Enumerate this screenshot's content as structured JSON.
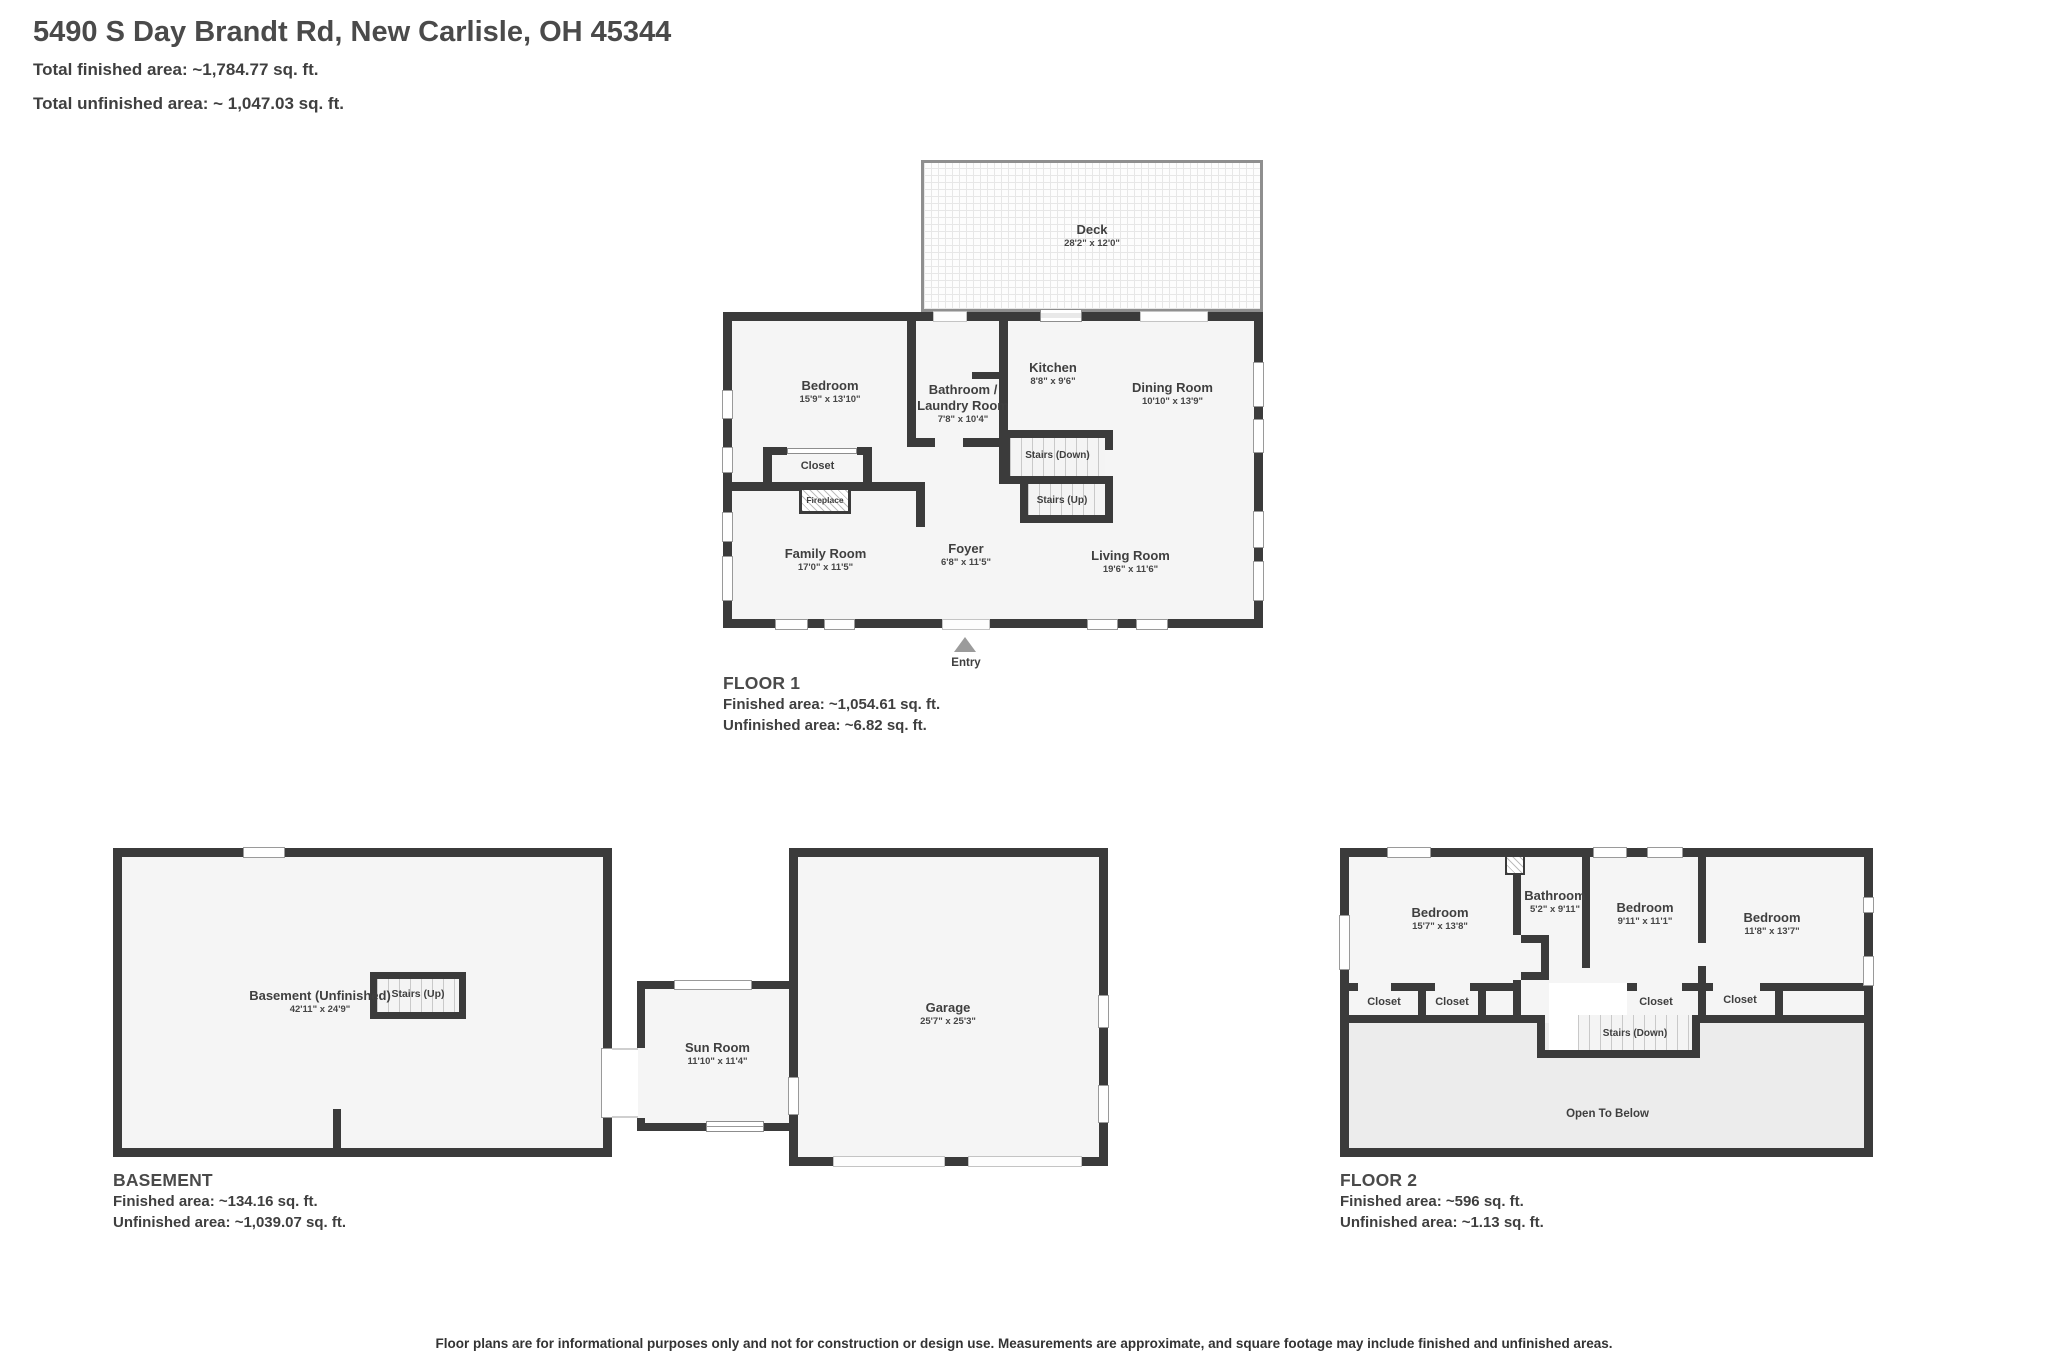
{
  "header": {
    "title": "5490 S Day Brandt Rd, New Carlisle, OH 45344",
    "total_finished": "Total finished area: ~1,784.77 sq. ft.",
    "total_unfinished": "Total unfinished area: ~ 1,047.03 sq. ft."
  },
  "floor1": {
    "title": "FLOOR 1",
    "finished": "Finished area: ~1,054.61 sq. ft.",
    "unfinished": "Unfinished area: ~6.82 sq. ft.",
    "deck": {
      "name": "Deck",
      "dims": "28'2\" x 12'0\""
    },
    "bedroom": {
      "name": "Bedroom",
      "dims": "15'9\" x 13'10\""
    },
    "bathroom": {
      "name": "Bathroom /",
      "name2": "Laundry Room",
      "dims": "7'8\" x 10'4\""
    },
    "kitchen": {
      "name": "Kitchen",
      "dims": "8'8\" x 9'6\""
    },
    "dining": {
      "name": "Dining Room",
      "dims": "10'10\" x 13'9\""
    },
    "family": {
      "name": "Family Room",
      "dims": "17'0\" x 11'5\""
    },
    "foyer": {
      "name": "Foyer",
      "dims": "6'8\" x 11'5\""
    },
    "living": {
      "name": "Living Room",
      "dims": "19'6\" x 11'6\""
    },
    "closet": "Closet",
    "fireplace": "Fireplace",
    "stairs_down": "Stairs (Down)",
    "stairs_up": "Stairs (Up)",
    "entry": "Entry"
  },
  "basement": {
    "title": "BASEMENT",
    "finished": "Finished area: ~134.16 sq. ft.",
    "unfinished": "Unfinished area: ~1,039.07 sq. ft.",
    "room": {
      "name": "Basement (Unfinished)",
      "dims": "42'11\" x 24'9\""
    },
    "stairs_up": "Stairs (Up)",
    "sunroom": {
      "name": "Sun Room",
      "dims": "11'10\" x 11'4\""
    },
    "garage": {
      "name": "Garage",
      "dims": "25'7\" x 25'3\""
    }
  },
  "floor2": {
    "title": "FLOOR 2",
    "finished": "Finished area: ~596 sq. ft.",
    "unfinished": "Unfinished area: ~1.13 sq. ft.",
    "bedroom_left": {
      "name": "Bedroom",
      "dims": "15'7\" x 13'8\""
    },
    "bathroom": {
      "name": "Bathroom",
      "dims": "5'2\" x 9'11\""
    },
    "bedroom_mid": {
      "name": "Bedroom",
      "dims": "9'11\" x 11'1\""
    },
    "bedroom_right": {
      "name": "Bedroom",
      "dims": "11'8\" x 13'7\""
    },
    "closets": [
      "Closet",
      "Closet",
      "Closet",
      "Closet"
    ],
    "stairs_down": "Stairs (Down)",
    "open_below": "Open To Below"
  },
  "footer": {
    "disclaimer": "Floor plans are for informational purposes only and not for construction or design use. Measurements are approximate, and square footage may include finished and unfinished areas."
  },
  "colors": {
    "wall": "#3b3b3b",
    "text": "#3f3f3f",
    "room_fill": "#f5f5f5",
    "open_fill": "#ececec"
  }
}
